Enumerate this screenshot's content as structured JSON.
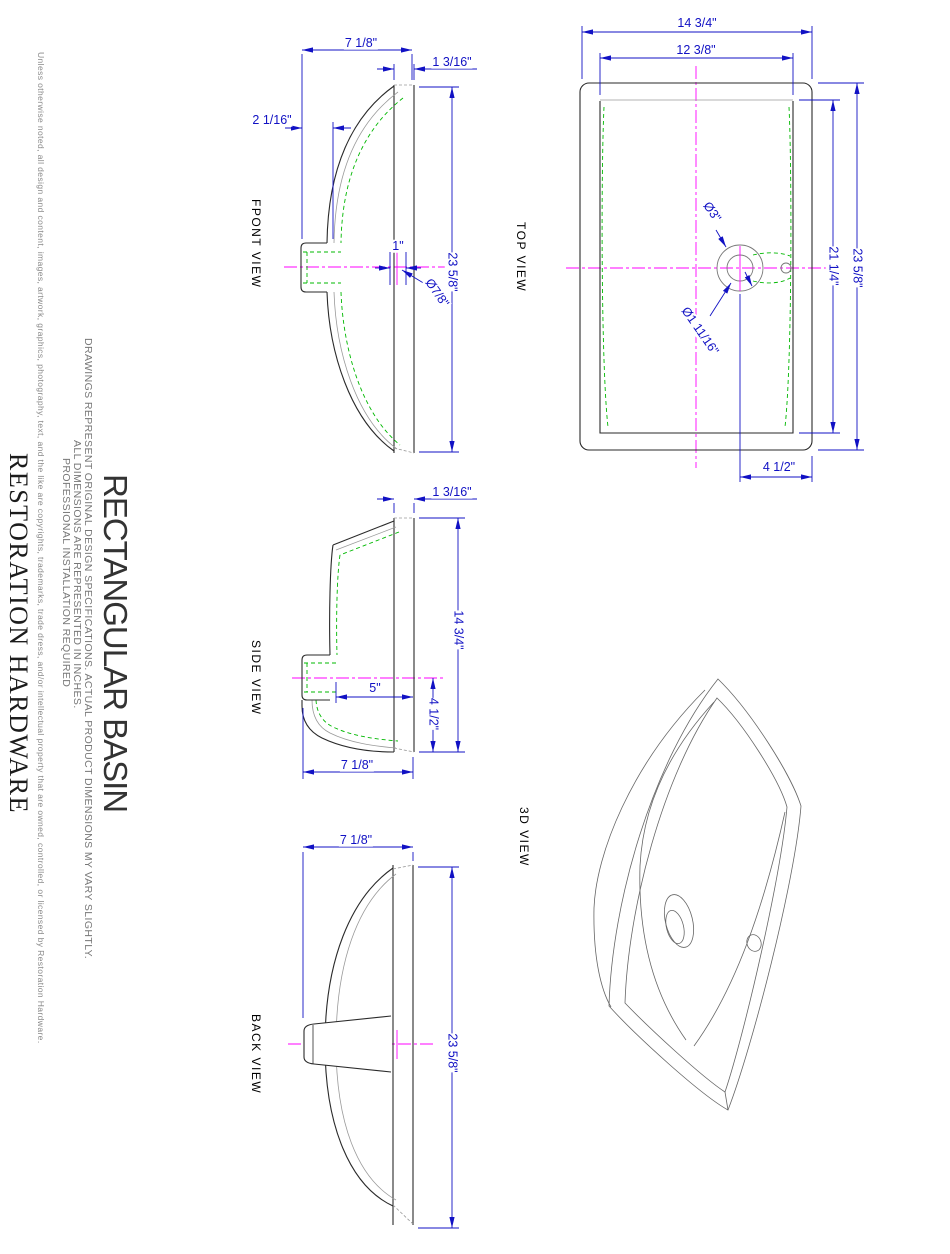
{
  "branding": {
    "company": "RESTORATION HARDWARE",
    "copyright": "Unless otherwise noted, all design and content, images, artwork, graphics, photography, text, and the like are copyrights, trademarks, trade dress, and/or intellectual property that are owned, controlled, or licensed by Restoration Hardware."
  },
  "title_block": {
    "product_title": "RECTANGULAR BASIN",
    "note_specs": "DRAWINGS REPRESENT ORIGINAL DESIGN SPECIFICATIONS. ACTUAL PRODUCT DIMENSIONS MY VARY SLIGHTLY.",
    "note_units": "ALL DIMENSIONS ARE REPRESENTED IN INCHES.",
    "note_install": "PROFESSIONAL INSTALLATION REQUIRED"
  },
  "colors": {
    "dimension_blue": "#1111c4",
    "hidden_green": "#00b800",
    "centerline_magenta": "#ff00ff",
    "outline_black": "#2a2a2a",
    "projection_gray": "#9a9a9a"
  },
  "views": {
    "top": {
      "label": "TOP VIEW",
      "dims": {
        "outer_width": "14 3/4\"",
        "inner_width": "12 3/8\"",
        "outer_length": "23 5/8\"",
        "inner_length": "21 1/4\"",
        "faucet_hole": "Ø3\"",
        "drain_hole": "Ø1 11/16\"",
        "faucet_center_offset": "4 1/2\""
      }
    },
    "front": {
      "label": "FPONT VIEW",
      "dims": {
        "depth": "7 1/8\"",
        "rim_thickness": "1 3/16\"",
        "drain_stub_width": "2 1/16\"",
        "drain_rim_width": "1\"",
        "drain_hole": "Ø7/8\"",
        "length": "23 5/8\""
      }
    },
    "side": {
      "label": "SIDE VIEW",
      "dims": {
        "rim_thickness": "1 3/16\"",
        "width": "14 3/4\"",
        "bowl_inner_depth": "5\"",
        "center_to_bottom": "4 1/2\"",
        "depth": "7 1/8\""
      }
    },
    "back": {
      "label": "BACK VIEW",
      "dims": {
        "depth": "7 1/8\"",
        "length": "23 5/8\""
      }
    },
    "three_d": {
      "label": "3D VIEW"
    }
  }
}
